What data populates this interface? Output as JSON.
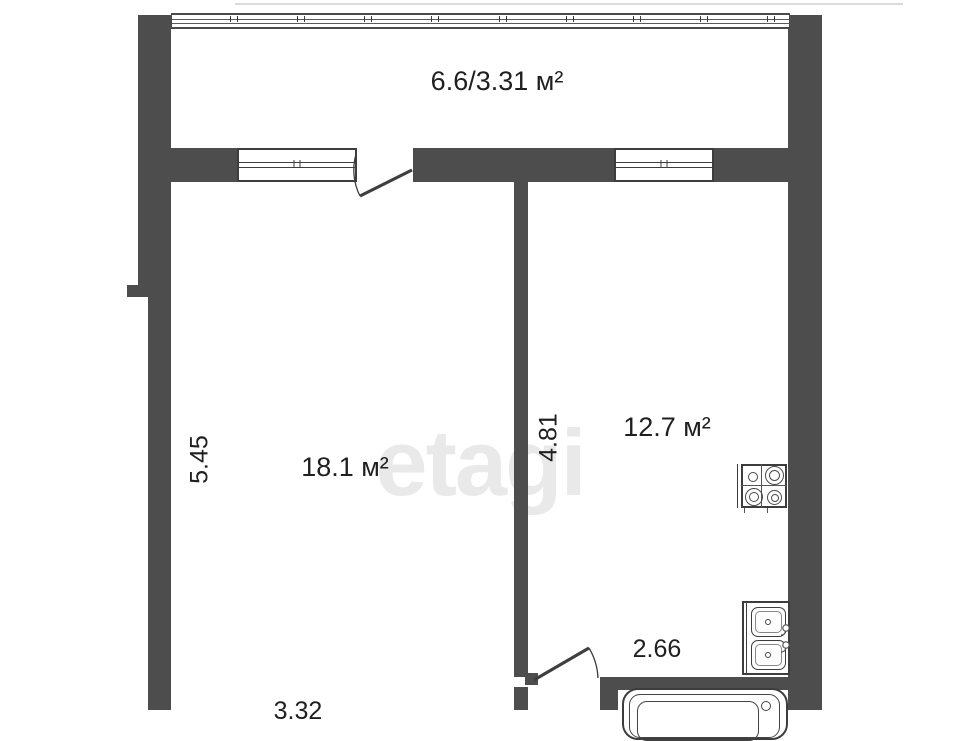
{
  "watermark": "etagi",
  "colors": {
    "wall": "#4d4d4d",
    "line": "#3d3d3d",
    "text": "#1f1f1f",
    "watermark": "#e9e9e9",
    "background": "#ffffff"
  },
  "rooms": {
    "balcony": {
      "area": "6.6/3.31 м²"
    },
    "living": {
      "area": "18.1 м²",
      "dim_vertical": "5.45",
      "dim_horizontal": "3.32"
    },
    "kitchen": {
      "area": "12.7 м²",
      "dim_vertical": "4.81",
      "dim_horizontal": "2.66"
    }
  },
  "fixtures": {
    "stove": "stove-4-burners",
    "sink": "double-sink",
    "bathtub": "bathtub",
    "balcony_glazing": "glazed-window-band",
    "windows": 2,
    "doors": 2
  }
}
